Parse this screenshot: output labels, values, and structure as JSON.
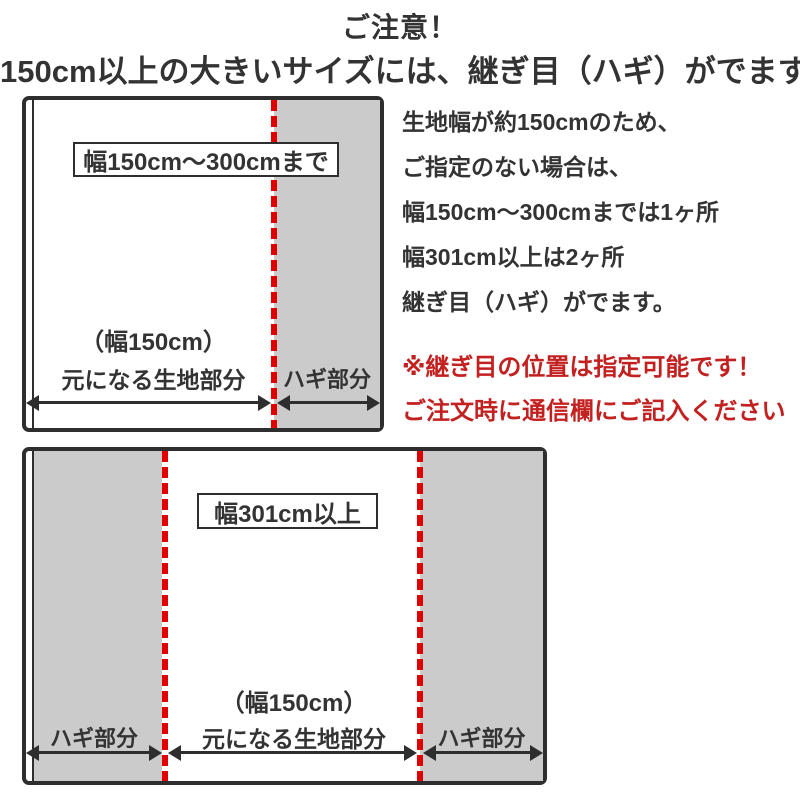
{
  "page": {
    "title": "ご注意！",
    "subtitle": "150cm以上の大きいサイズには、継ぎ目（ハギ）がでます"
  },
  "info": {
    "lines": [
      "生地幅が約150cmのため、",
      "ご指定のない場合は、",
      "幅150cm〜300cmまでは1ヶ所",
      "幅301cm以上は2ヶ所",
      "継ぎ目（ハギ）がでます。"
    ]
  },
  "notice": {
    "lines": [
      "※継ぎ目の位置は指定可能です！",
      "ご注文時に通信欄にご記入ください"
    ]
  },
  "diagram_top": {
    "size_label": "幅150cm〜300cmまで",
    "base_width_label": "（幅150cm）",
    "base_fabric_label": "元になる生地部分",
    "hagi_label": "ハギ部分"
  },
  "diagram_bottom": {
    "size_label": "幅301cm以上",
    "base_width_label": "（幅150cm）",
    "base_fabric_label": "元になる生地部分",
    "hagi_label_left": "ハギ部分",
    "hagi_label_right": "ハギ部分"
  },
  "colors": {
    "border": "#2e2e2e",
    "gray_fill": "#cbcbcb",
    "seam_dash_red": "#e00000",
    "notice_red": "#c32020",
    "text": "#333333"
  }
}
